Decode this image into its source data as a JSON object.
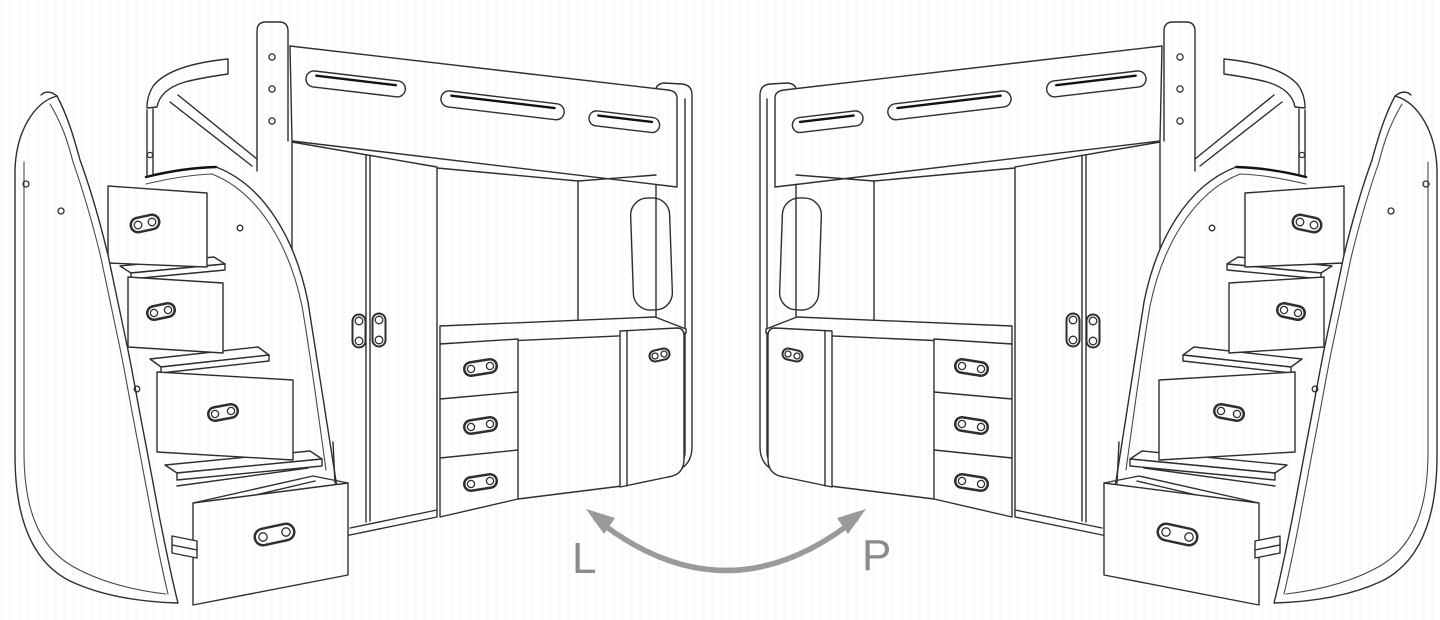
{
  "page": {
    "background_color": "#ffffff"
  },
  "diagram": {
    "description": "Mirrored loft-bed units (stairs with drawers, wardrobe, desk) shown as left-hand and right-hand versions",
    "line_color": "#2f2f2f",
    "label_color": "#8c8c8c",
    "variant_labels": {
      "left": "L",
      "right": "P"
    },
    "swap_arrow": {
      "style": "curved double-headed",
      "color": "#9b9b9b"
    },
    "parts": [
      "loft-bed",
      "guard-rail",
      "headboard",
      "staircase-drawers",
      "pull-out-drawer",
      "wardrobe",
      "desk",
      "drawer-pedestal",
      "side-cabinet",
      "side-panel-cutout"
    ]
  }
}
